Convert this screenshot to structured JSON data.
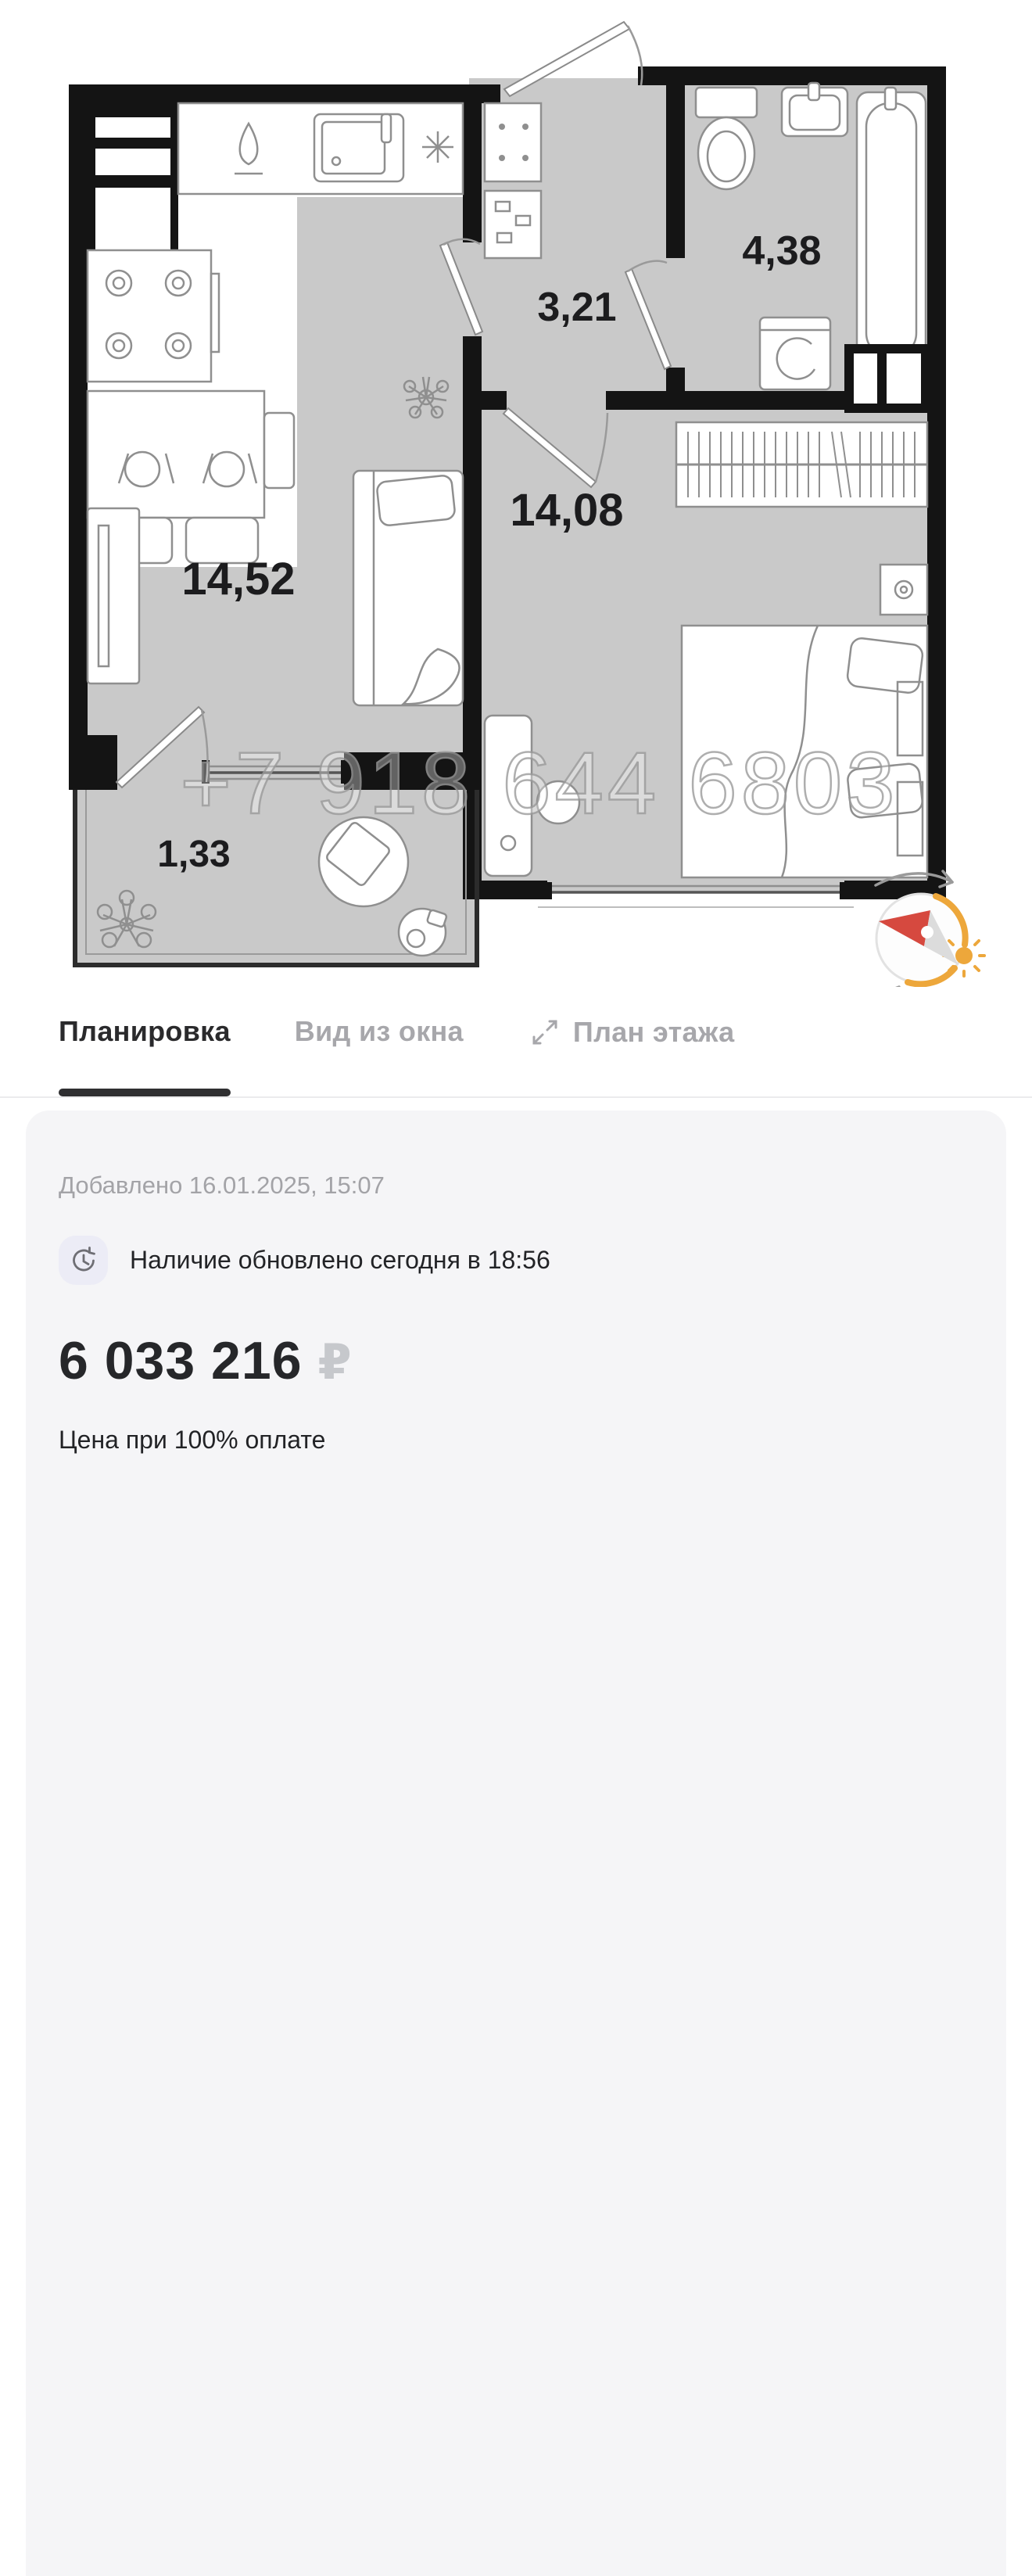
{
  "floor_plan": {
    "watermark": "+7 918 644 6803",
    "rooms": [
      {
        "id": "living-kitchen",
        "area": "14,52"
      },
      {
        "id": "hallway",
        "area": "3,21"
      },
      {
        "id": "bathroom",
        "area": "4,38"
      },
      {
        "id": "bedroom",
        "area": "14,08"
      },
      {
        "id": "balcony",
        "area": "1,33"
      }
    ],
    "icons": {
      "compass": "compass-needle with sun and rotate arrows",
      "sun": "☀",
      "rotate": "⟳"
    },
    "colors": {
      "floor": "#C9C9C9",
      "wall": "#141414",
      "compass_accent": "#EDA73B",
      "compass_needle_red": "#D6493F",
      "compass_needle_gray": "#D9D9D9"
    }
  },
  "tabs": [
    {
      "label": "Планировка",
      "active": true
    },
    {
      "label": "Вид из окна",
      "active": false
    },
    {
      "label": "План этажа",
      "active": false,
      "icon": "expand-icon"
    }
  ],
  "info_card": {
    "added": "Добавлено 16.01.2025, 15:07",
    "availability": "Наличие обновлено сегодня в 18:56",
    "availability_icon": "clock-refresh-icon",
    "price": "6 033 216",
    "currency": "₽",
    "price_note": "Цена при 100% оплате"
  },
  "ui_colors": {
    "tab_active": "#2A2A2C",
    "tab_inactive": "#A7A7AB",
    "card_bg": "#F5F5F7",
    "badge_bg": "#ECECF6",
    "muted_text": "#A3A3A7",
    "price_text": "#26272A",
    "currency_text": "#C6C8CC"
  }
}
